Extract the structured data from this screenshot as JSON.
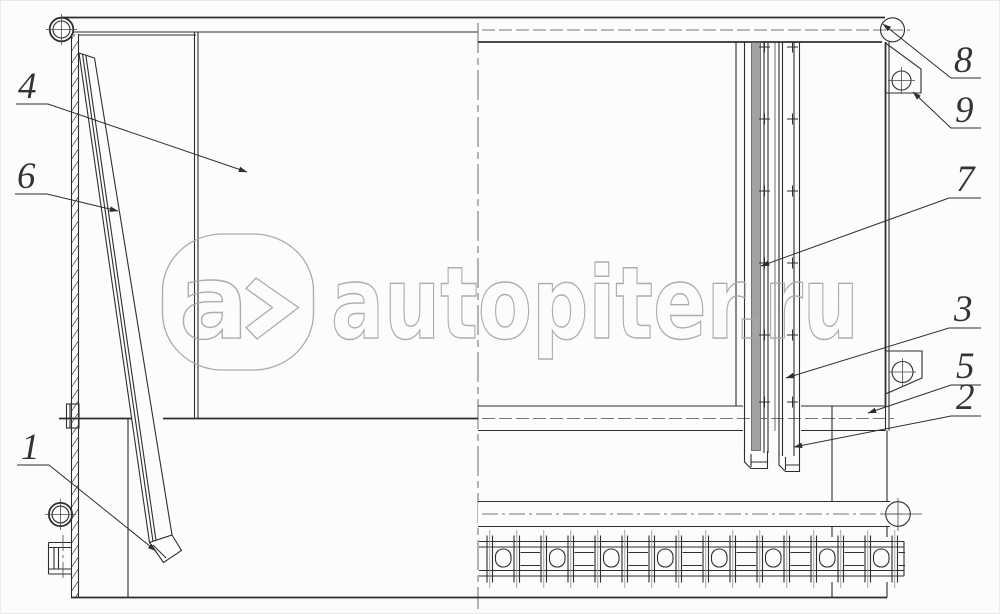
{
  "page": {
    "background": "#fcfcfa",
    "ink_color": "#2e2e2e",
    "description": "Technical assembly drawing of a platform side board with stake, rails, brackets and hinge chain"
  },
  "watermark": {
    "logo_char": "a",
    "brand_text": "autopiter.ru",
    "color": "#a9a9a9"
  },
  "callouts": [
    {
      "num": "1"
    },
    {
      "num": "2"
    },
    {
      "num": "3"
    },
    {
      "num": "4"
    },
    {
      "num": "5"
    },
    {
      "num": "6"
    },
    {
      "num": "7"
    },
    {
      "num": "8"
    },
    {
      "num": "9"
    }
  ]
}
